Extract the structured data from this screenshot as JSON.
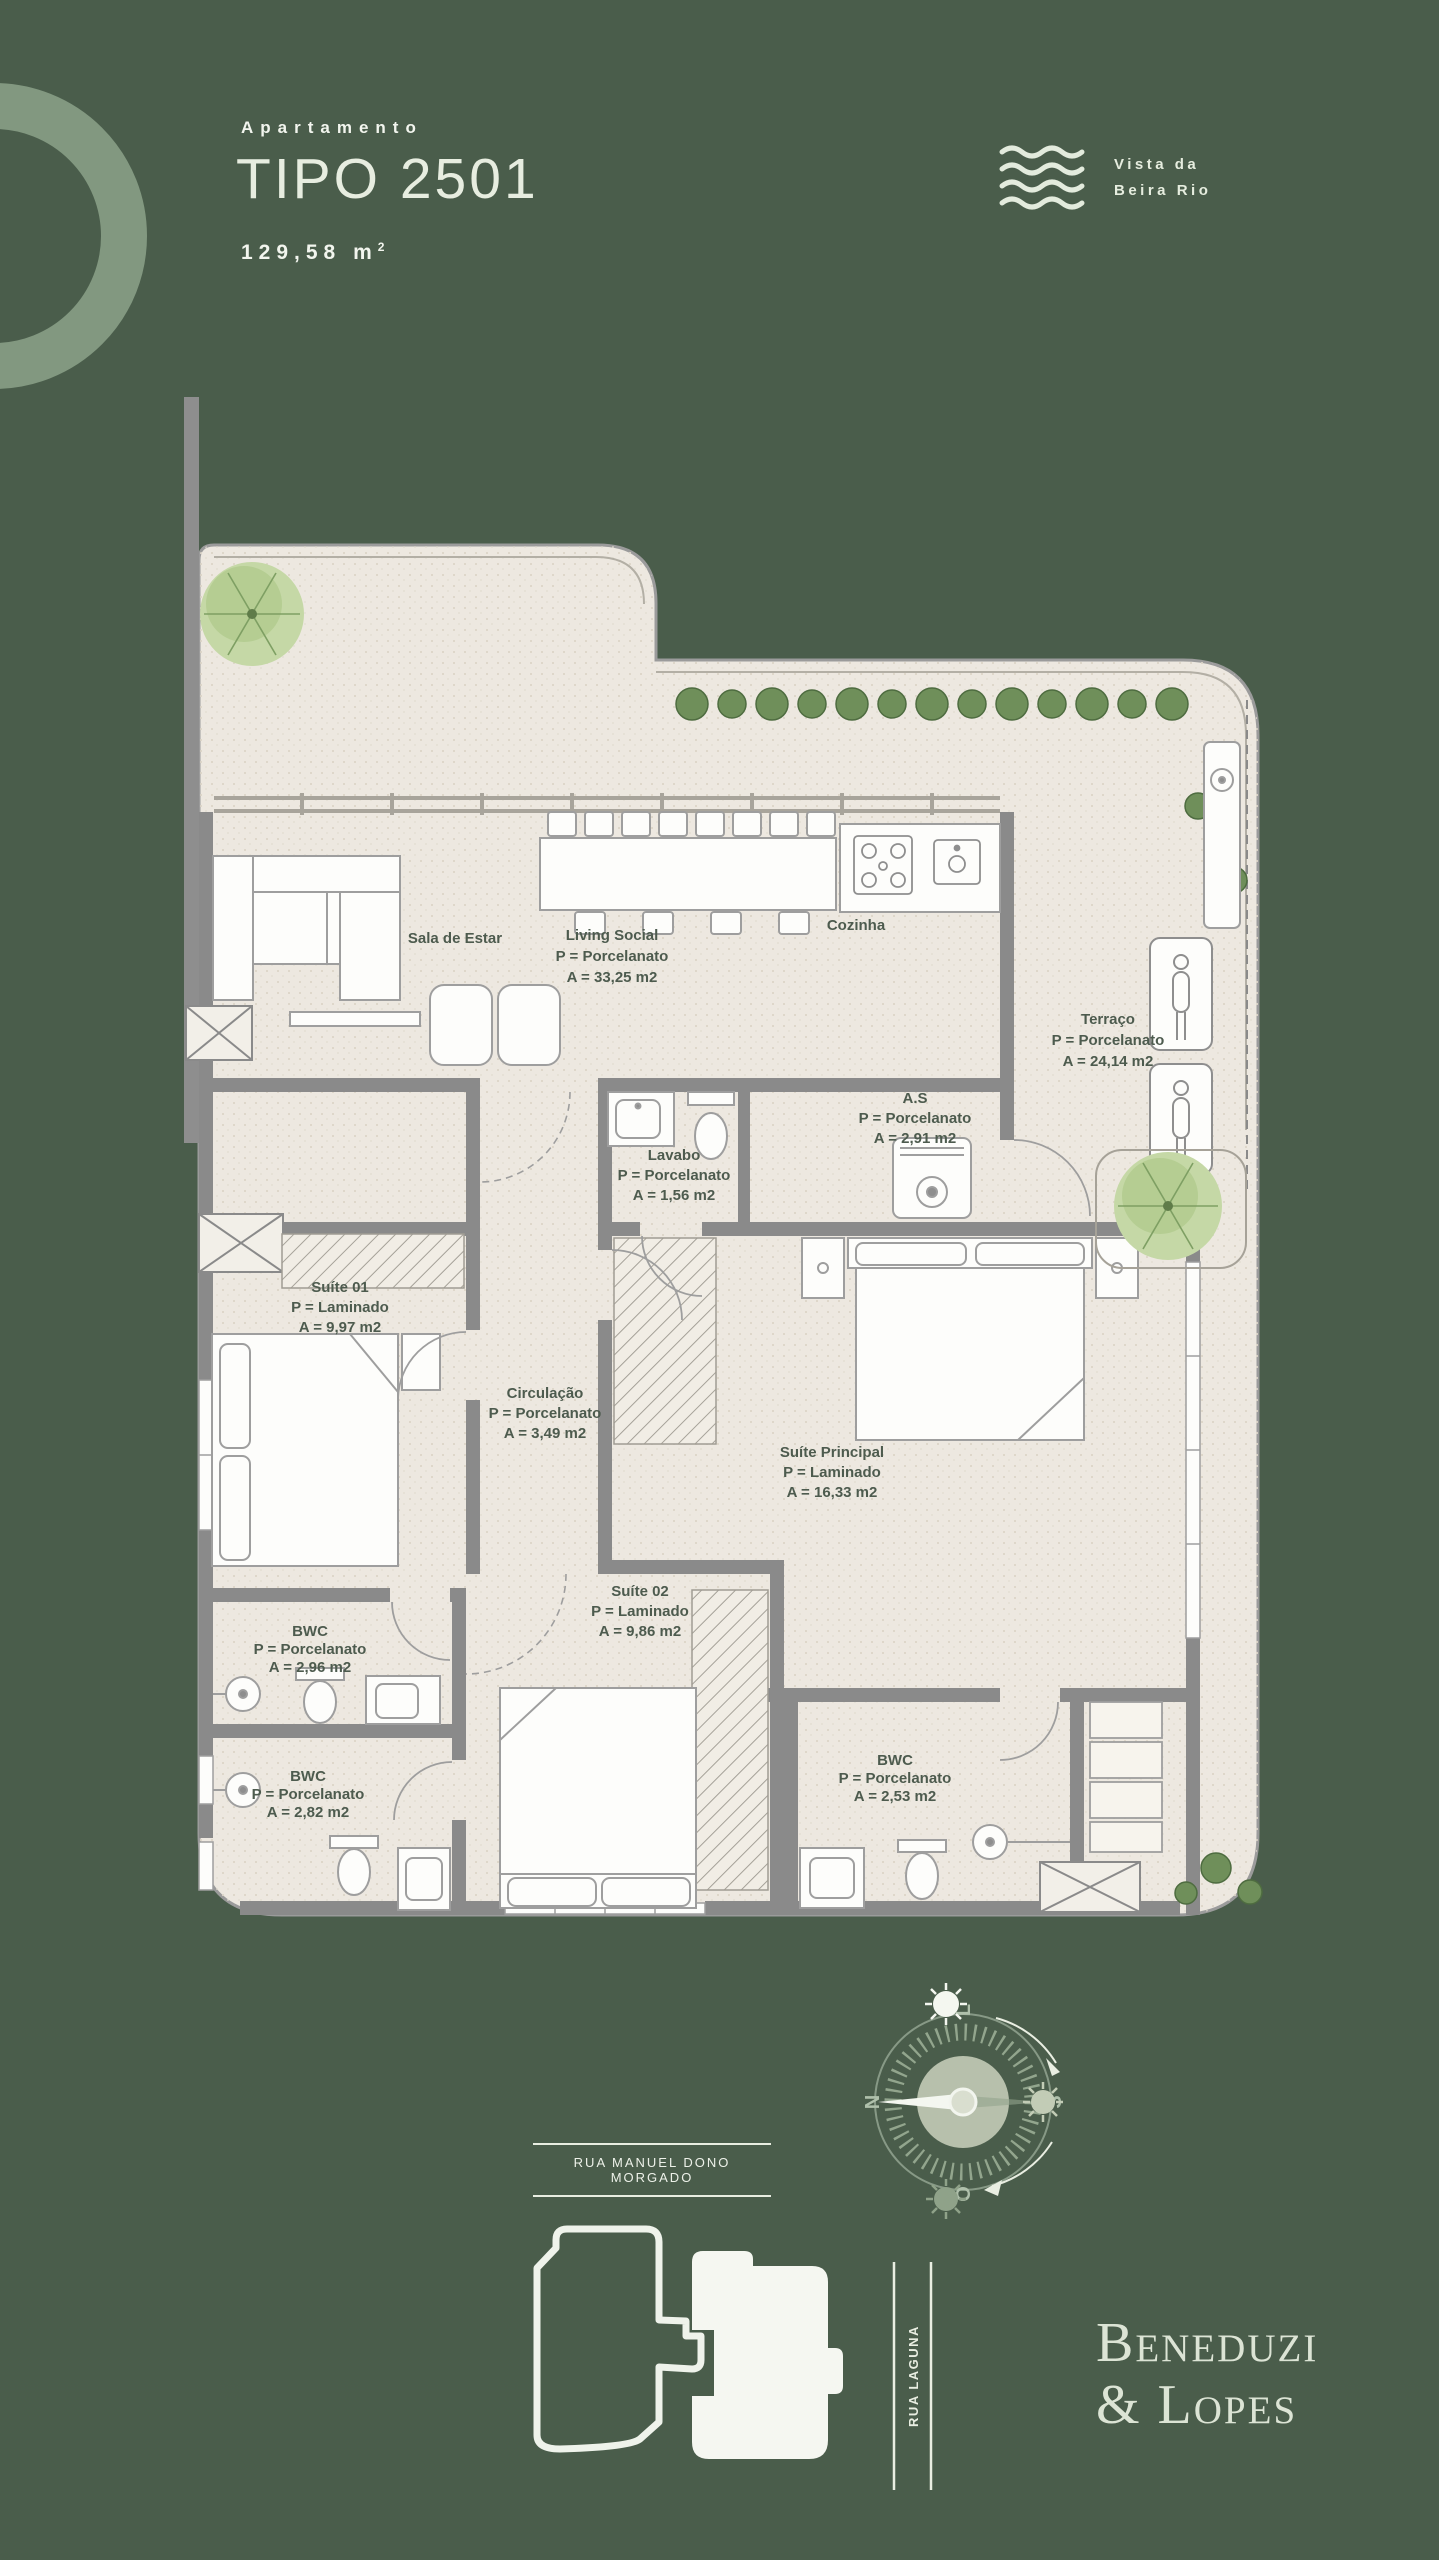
{
  "header": {
    "eyebrow": "Apartamento",
    "title": "TIPO 2501",
    "area_value": "129,58 m",
    "area_sup": "2"
  },
  "view_badge": {
    "icon": "waves-icon",
    "line1": "Vista da",
    "line2": "Beira Rio"
  },
  "floor_plan": {
    "rooms": [
      {
        "name": "Sala de Estar",
        "floor": "",
        "area": ""
      },
      {
        "name": "Living Social",
        "floor": "P = Porcelanato",
        "area": "A = 33,25 m2"
      },
      {
        "name": "Cozinha",
        "floor": "",
        "area": ""
      },
      {
        "name": "Terraço",
        "floor": "P = Porcelanato",
        "area": "A = 24,14 m2"
      },
      {
        "name": "A.S",
        "floor": "P = Porcelanato",
        "area": "A = 2,91 m2"
      },
      {
        "name": "Lavabo",
        "floor": "P = Porcelanato",
        "area": "A = 1,56 m2"
      },
      {
        "name": "Suíte 01",
        "floor": "P = Laminado",
        "area": "A = 9,97 m2"
      },
      {
        "name": "Circulação",
        "floor": "P = Porcelanato",
        "area": "A = 3,49 m2"
      },
      {
        "name": "Suíte Principal",
        "floor": "P = Laminado",
        "area": "A = 16,33 m2"
      },
      {
        "name": "Suíte 02",
        "floor": "P = Laminado",
        "area": "A = 9,86 m2"
      },
      {
        "name": "BWC",
        "floor": "P = Porcelanato",
        "area": "A = 2,96 m2"
      },
      {
        "name": "BWC",
        "floor": "P = Porcelanato",
        "area": "A = 2,82 m2"
      },
      {
        "name": "BWC",
        "floor": "P = Porcelanato",
        "area": "A = 2,53 m2"
      }
    ],
    "colors": {
      "background": "#4A5D4B",
      "accent_light": "#8CA28A",
      "floor": "#EDE8E0",
      "wall": "#8A8A8A",
      "label_text": "#4D5B4E",
      "plant_green": "#6F8F5A",
      "brand_text": "#DCE4D5"
    }
  },
  "compass": {
    "n": "N",
    "e": "L",
    "s": "S",
    "w": "O"
  },
  "streets": {
    "bottom": "RUA MANUEL DONO MORGADO",
    "side": "RUA LAGUNA"
  },
  "brand": {
    "line1": "Beneduzi",
    "line2": "& Lopes"
  }
}
